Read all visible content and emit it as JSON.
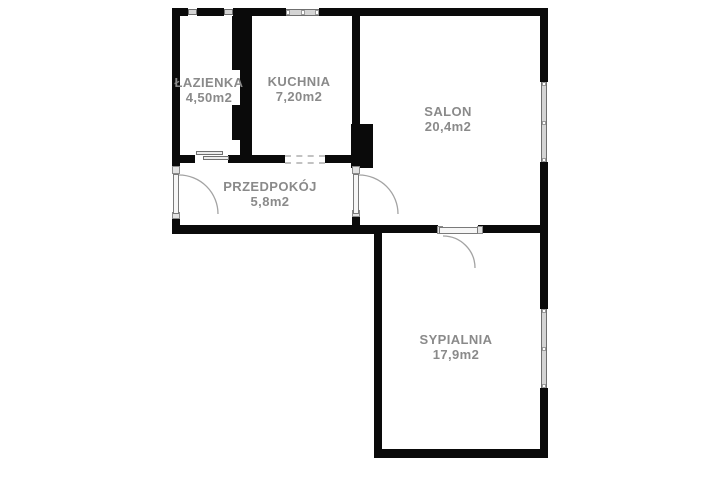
{
  "plan": {
    "type": "apartment-floor-plan",
    "colors": {
      "background": "#ffffff",
      "wall": "#0a0a0a",
      "window_fill": "#d4d4d4",
      "door_arc": "#a3a3a3",
      "label_text": "#8a8a8a"
    },
    "rooms": [
      {
        "id": "lazienka",
        "name": "ŁAZIENKA",
        "area": "4,50m2"
      },
      {
        "id": "kuchnia",
        "name": "KUCHNIA",
        "area": "7,20m2"
      },
      {
        "id": "salon",
        "name": "SALON",
        "area": "20,4m2"
      },
      {
        "id": "przedpokoj",
        "name": "PRZEDPOKÓJ",
        "area": "5,8m2"
      },
      {
        "id": "sypialnia",
        "name": "SYPIALNIA",
        "area": "17,9m2"
      }
    ]
  }
}
